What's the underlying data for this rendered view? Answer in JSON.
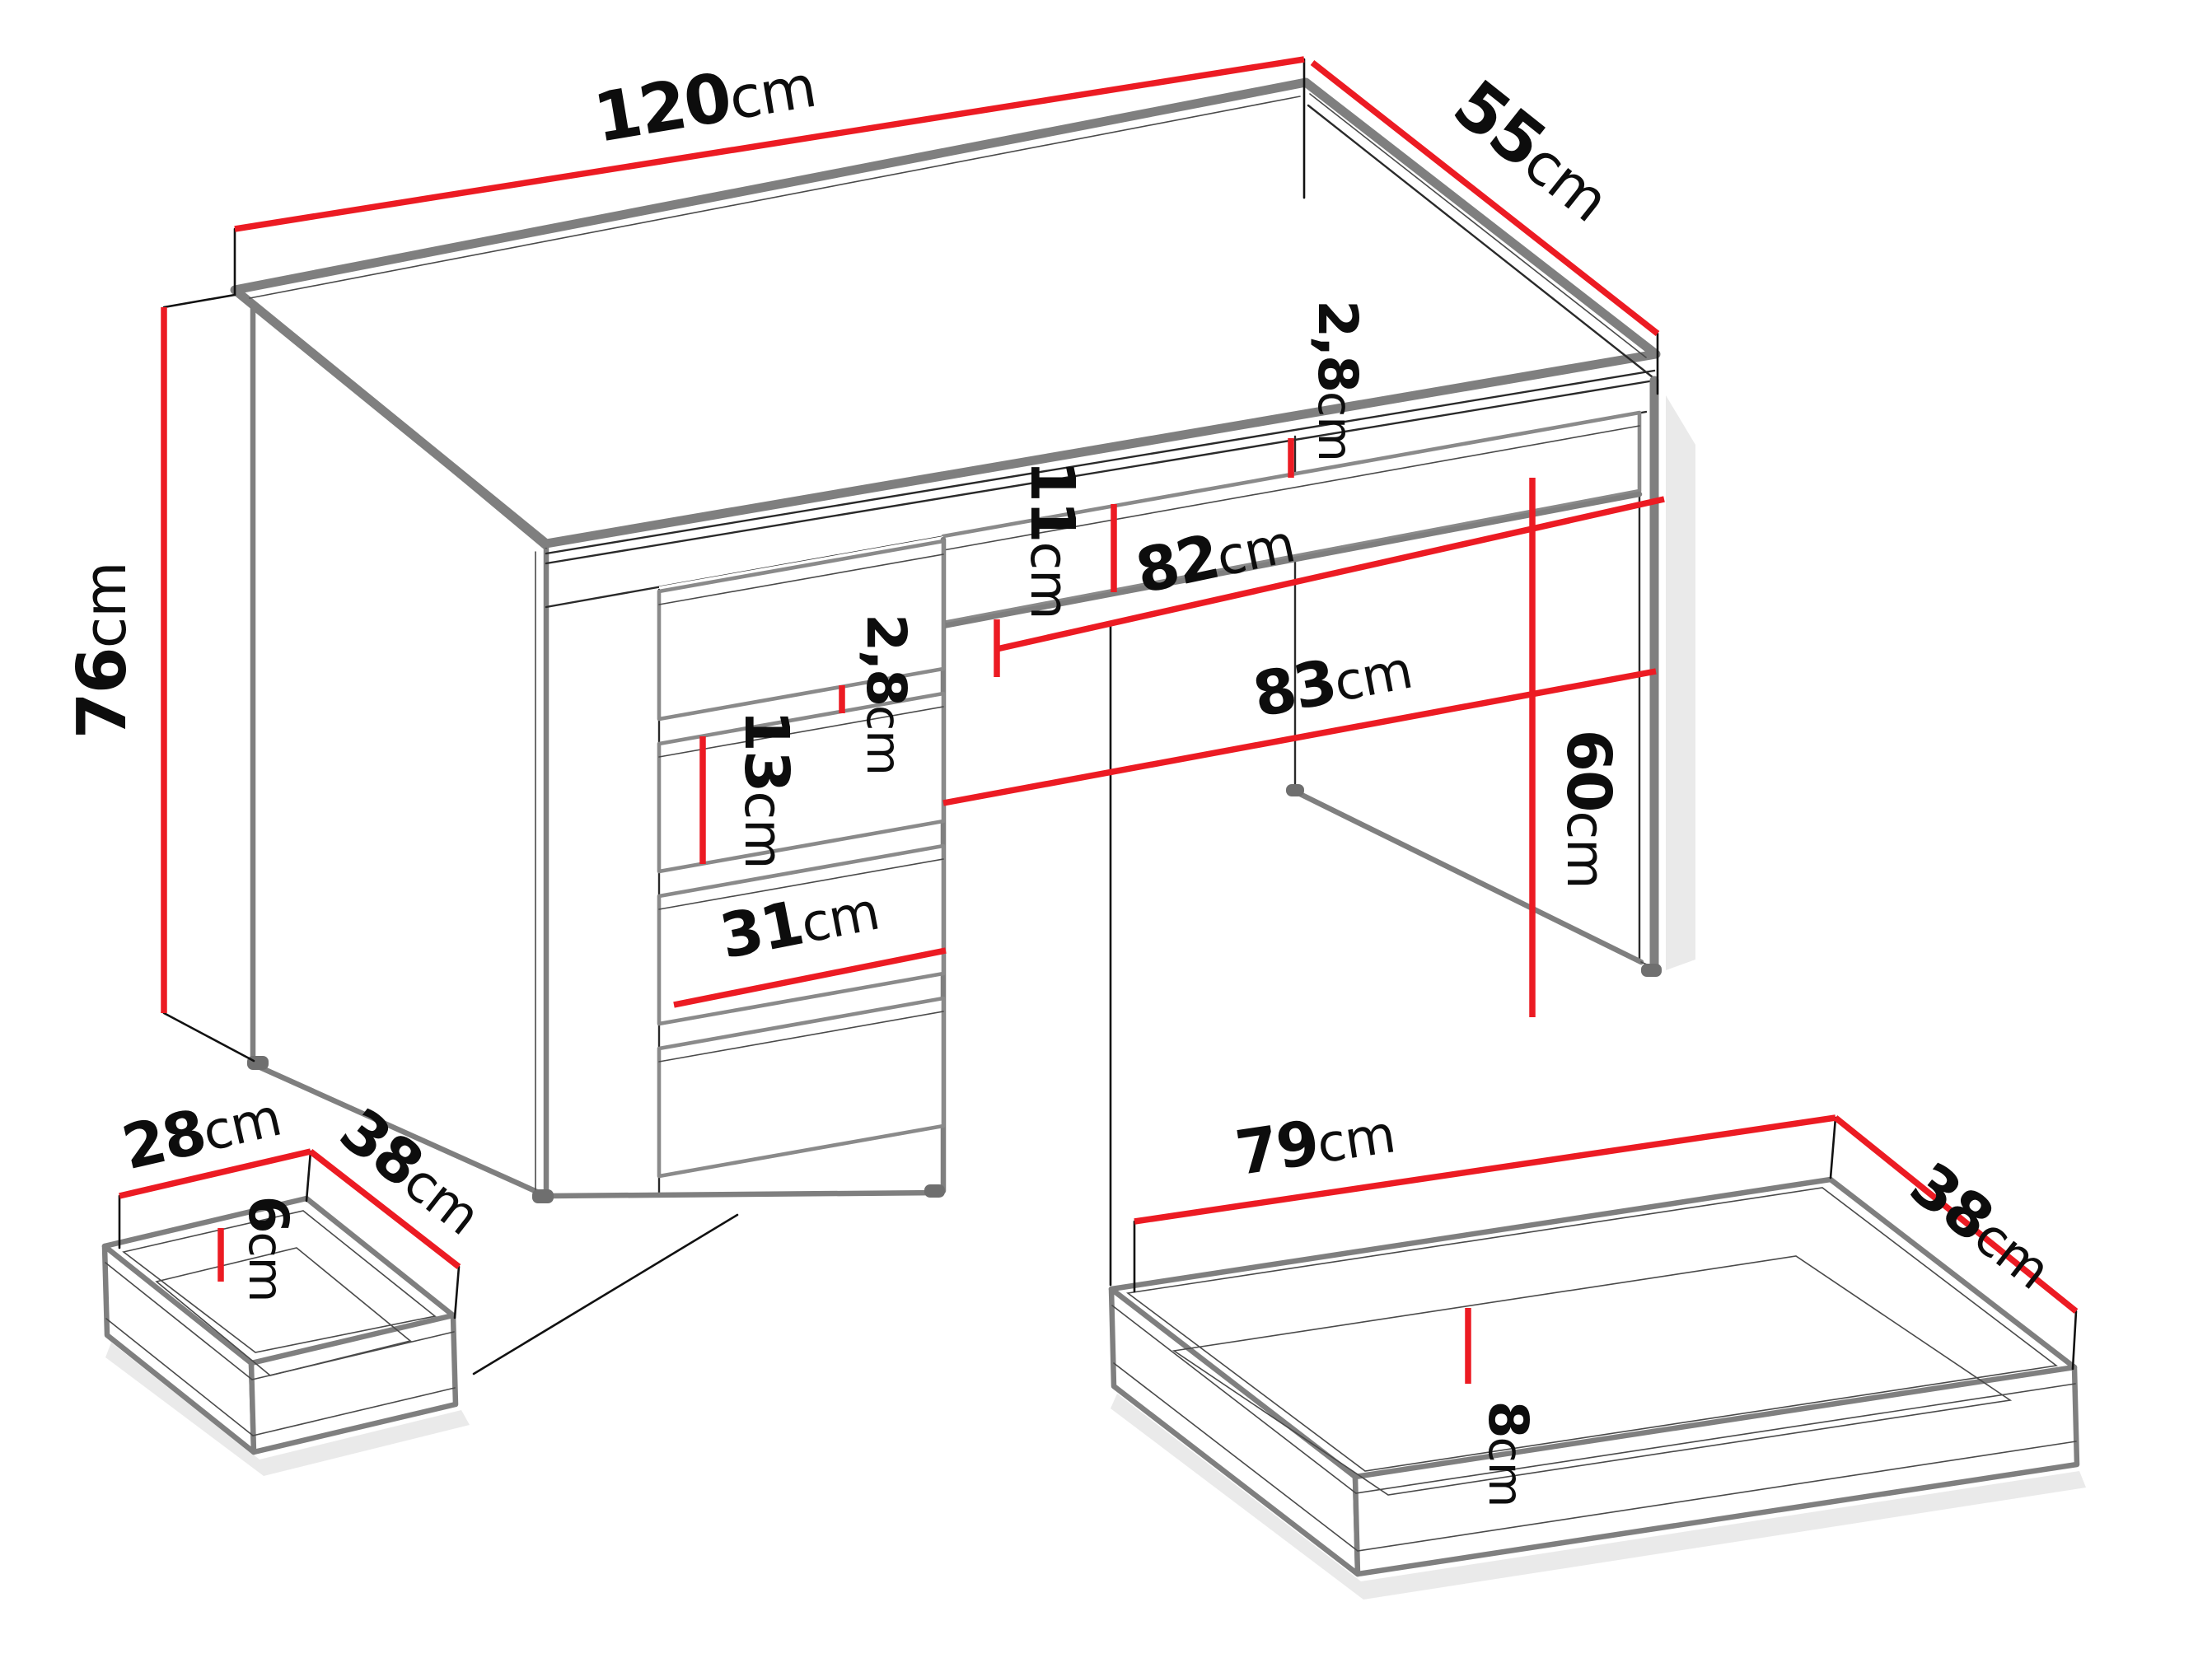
{
  "diagram": {
    "title": "desk-dimensions-technical-drawing",
    "unit": "cm",
    "colors": {
      "dimension_line": "#ec1b23",
      "outline_gray": "#7f7f7f",
      "detail_line": "#2a2a2a",
      "label_text": "#0d0d0d",
      "background": "#ffffff"
    },
    "desk": {
      "width": {
        "value": "120",
        "unit": "cm"
      },
      "depth": {
        "value": "55",
        "unit": "cm"
      },
      "height": {
        "value": "76",
        "unit": "cm"
      },
      "top_rail_height": {
        "value": "2,8",
        "unit": "cm"
      },
      "pencil_drawer_front_height": {
        "value": "11",
        "unit": "cm"
      },
      "pencil_drawer_width": {
        "value": "82",
        "unit": "cm"
      },
      "knee_space_width": {
        "value": "83",
        "unit": "cm"
      },
      "knee_space_height": {
        "value": "60",
        "unit": "cm"
      },
      "drawer_gap": {
        "value": "2,8",
        "unit": "cm"
      },
      "drawer_front_height": {
        "value": "13",
        "unit": "cm"
      },
      "drawer_front_width": {
        "value": "31",
        "unit": "cm"
      }
    },
    "small_drawer": {
      "depth": {
        "value": "28",
        "unit": "cm"
      },
      "width": {
        "value": "38",
        "unit": "cm"
      },
      "inner_height": {
        "value": "6",
        "unit": "cm"
      }
    },
    "large_drawer": {
      "width": {
        "value": "79",
        "unit": "cm"
      },
      "depth": {
        "value": "38",
        "unit": "cm"
      },
      "inner_height": {
        "value": "8",
        "unit": "cm"
      }
    }
  }
}
